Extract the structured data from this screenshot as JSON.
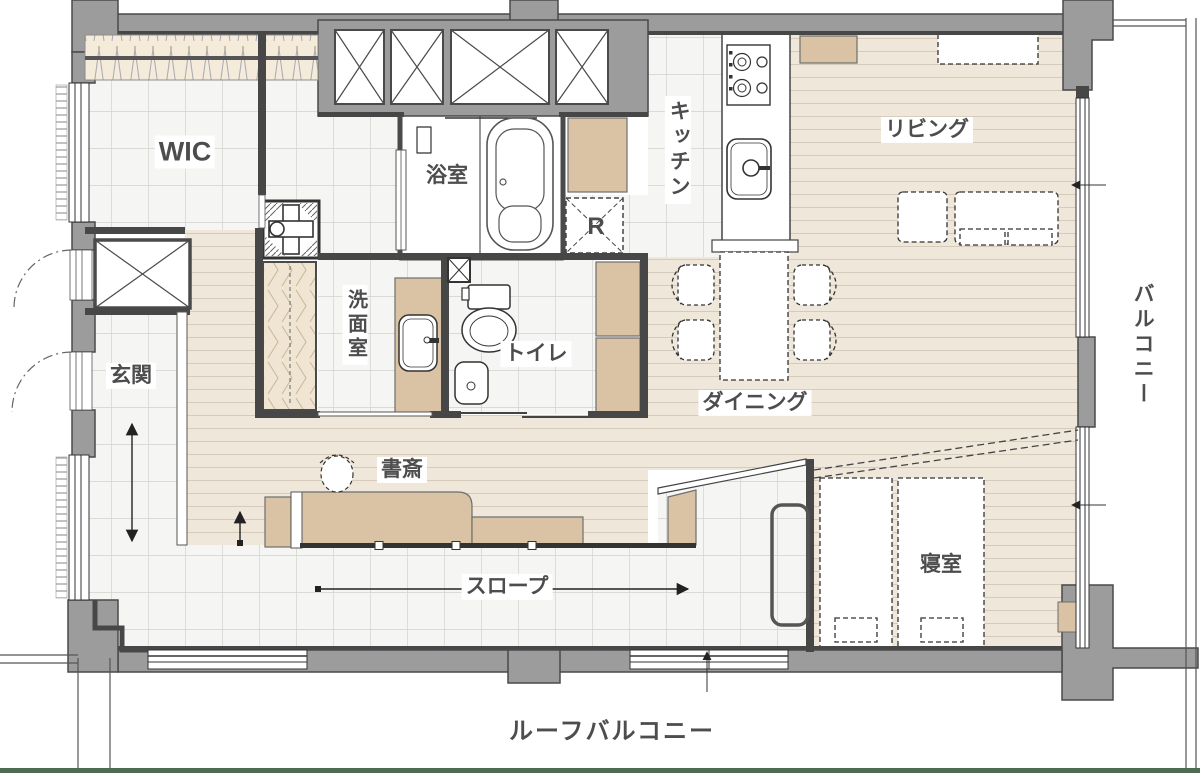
{
  "labels": {
    "wic": "WIC",
    "bathroom": "浴室",
    "kitchen": "キッチン",
    "living": "リビング",
    "balcony": "バルコニー",
    "refrigerator": "R",
    "washroom": "洗面室",
    "toilet": "トイレ",
    "dining": "ダイニング",
    "entrance": "玄関",
    "study": "書斎",
    "slope": "スロープ",
    "bedroom": "寝室",
    "roof_balcony": "ルーフバルコニー"
  },
  "colors": {
    "wall_fill": "#9c9c9c",
    "wall_dark": "#474747",
    "wood_floor": "#eee7da",
    "tile_floor": "#f5f5f3",
    "furniture_tan": "#d9c3a4",
    "closet_beige": "#f4ebdb",
    "outline": "#333333",
    "label_text": "#4d4d4d",
    "bottom_border_green": "#4e6b52"
  },
  "fixtures": {
    "bath": "bathtub-icon",
    "toilet": "toilet-icon",
    "wash_basin": "sink-icon",
    "hand_sink": "small-sink-icon",
    "stove": "gas-stove-icon",
    "kitchen_sink": "kitchen-sink-icon",
    "washer_pan": "washing-machine-pan-icon",
    "dining_set": "dining-table-chairs-icon",
    "sofa": "sofa-icon",
    "tv_board": "tv-board-icon",
    "beds": "twin-beds-icon",
    "desk_chair": "desk-chair-icon",
    "slope_arrow": "direction-arrow-icon"
  }
}
